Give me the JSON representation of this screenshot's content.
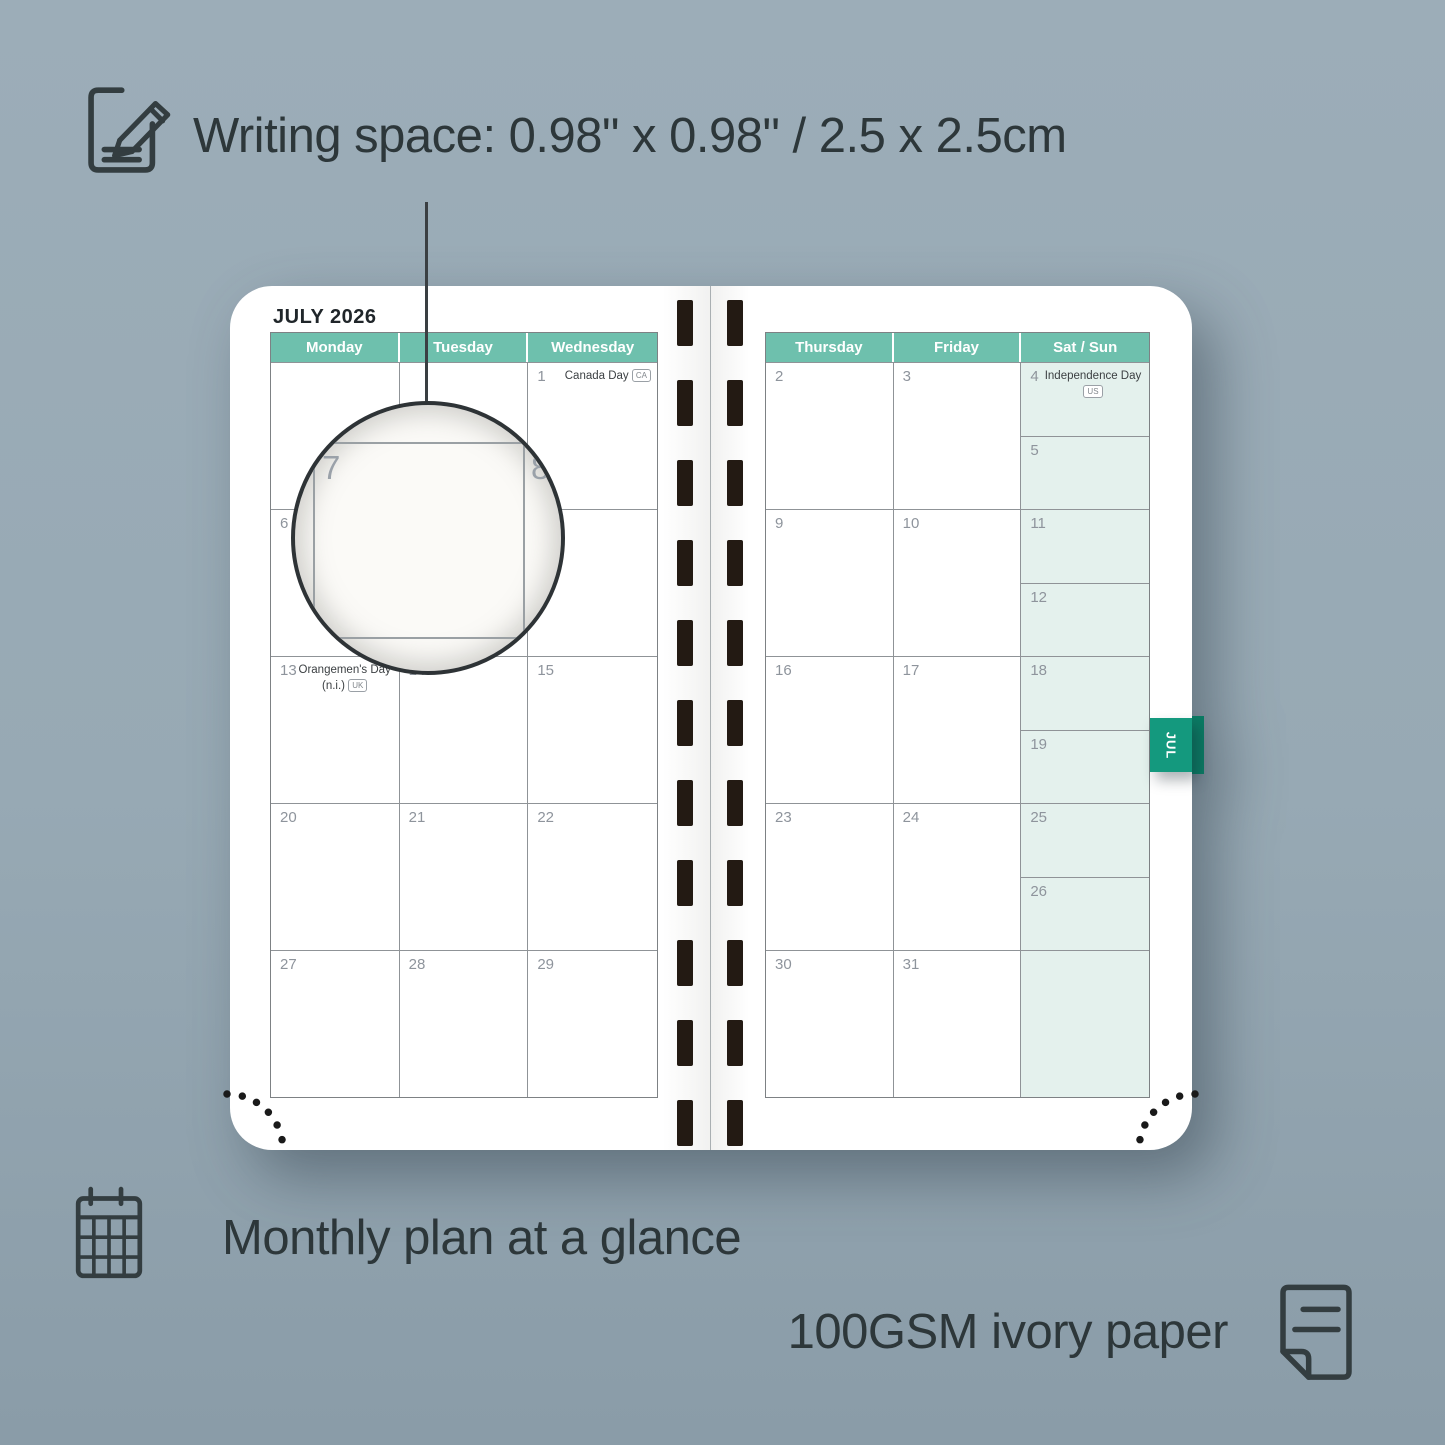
{
  "annotations": {
    "writing_space": "Writing space: 0.98\" x 0.98\" / 2.5 x 2.5cm",
    "monthly_plan": "Monthly plan at a glance",
    "paper": "100GSM ivory paper"
  },
  "planner": {
    "month_title": "JULY 2026",
    "month_tab": "JUL",
    "left_page": {
      "day_headers": [
        "Monday",
        "Tuesday",
        "Wednesday"
      ],
      "weeks": [
        [
          {
            "d": ""
          },
          {
            "d": ""
          },
          {
            "d": "1",
            "holiday": "Canada Day",
            "badge": "CA"
          }
        ],
        [
          {
            "d": "6"
          },
          {
            "d": "7"
          },
          {
            "d": "8"
          }
        ],
        [
          {
            "d": "13",
            "holiday": "Orangemen's Day (n.i.)",
            "badge": "UK"
          },
          {
            "d": "14"
          },
          {
            "d": "15"
          }
        ],
        [
          {
            "d": "20"
          },
          {
            "d": "21"
          },
          {
            "d": "22"
          }
        ],
        [
          {
            "d": "27"
          },
          {
            "d": "28"
          },
          {
            "d": "29"
          }
        ]
      ]
    },
    "right_page": {
      "day_headers": [
        "Thursday",
        "Friday",
        "Sat / Sun"
      ],
      "weeks": [
        [
          {
            "d": "2"
          },
          {
            "d": "3"
          },
          {
            "split": [
              {
                "d": "4",
                "holiday": "Independence Day",
                "badge": "US"
              },
              {
                "d": "5"
              }
            ]
          }
        ],
        [
          {
            "d": "9"
          },
          {
            "d": "10"
          },
          {
            "split": [
              {
                "d": "11"
              },
              {
                "d": "12"
              }
            ]
          }
        ],
        [
          {
            "d": "16"
          },
          {
            "d": "17"
          },
          {
            "split": [
              {
                "d": "18"
              },
              {
                "d": "19"
              }
            ]
          }
        ],
        [
          {
            "d": "23"
          },
          {
            "d": "24"
          },
          {
            "split": [
              {
                "d": "25"
              },
              {
                "d": "26"
              }
            ]
          }
        ],
        [
          {
            "d": "30"
          },
          {
            "d": "31"
          },
          {
            "single": {
              "d": ""
            }
          }
        ]
      ]
    }
  },
  "magnifier": {
    "left_day": "7",
    "right_day": "8"
  },
  "colors": {
    "background": "#97a9b4",
    "header_teal": "#6ec0ad",
    "tab_teal": "#14997e",
    "weekend_mint": "#e4f1ed",
    "text_dark": "#2d373a"
  }
}
